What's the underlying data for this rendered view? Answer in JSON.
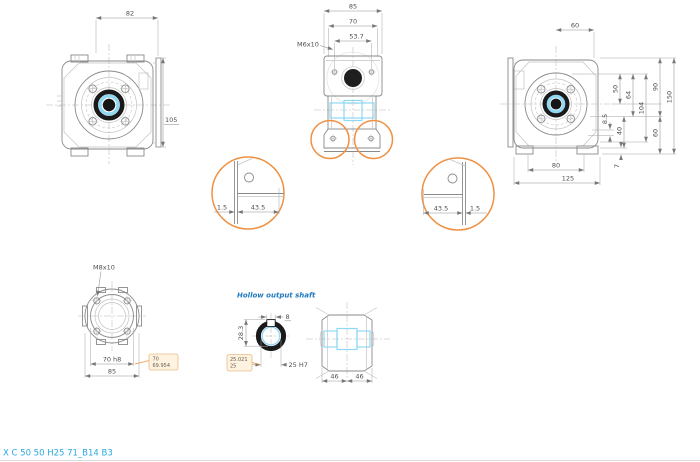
{
  "drawing": {
    "product_code": "X C 50 50 H25 71_B14 B3"
  },
  "colors": {
    "line": "#8a8a8a",
    "dark": "#1a1a1a",
    "dim_text": "#4f4f4f",
    "highlight_cyan": "#8fd8f4",
    "accent_orange": "#ef9143",
    "callout_fill": "#fdf3e0",
    "callout_border": "#e9bc86",
    "note_blue": "#1e79bf",
    "code_blue": "#2aa9e0"
  },
  "front_view": {
    "dim_width": "82",
    "dim_flange_height": "105"
  },
  "top_view": {
    "dim_overall": "85",
    "dim_bolt_circle": "70",
    "dim_bolt_spacing": "53.7",
    "thread_label": "M6x10"
  },
  "back_view": {
    "dim_top": "60",
    "dim_feet_spacing": "80",
    "dim_overall_width": "125",
    "dim_50": "50",
    "dim_64": "64",
    "dim_104": "104",
    "dim_90": "90",
    "dim_60_side": "60",
    "dim_150": "150",
    "dim_40": "40",
    "dim_8_5": "8.5",
    "dim_7": "7"
  },
  "detail_left": {
    "dim_wall": "1.5",
    "dim_foot": "43.5"
  },
  "detail_right": {
    "dim_foot": "43.5",
    "dim_wall": "1.5"
  },
  "flange_view": {
    "thread_label": "M8x10",
    "dim_spigot": "70 h8",
    "dim_overall": "85",
    "callout": {
      "nominal": "70",
      "tolerance": "69.954"
    }
  },
  "hollow_shaft": {
    "title": "Hollow output shaft",
    "dim_keyway_width": "8",
    "dim_keyway_depth": "28.3",
    "dim_bore": "25 H7",
    "callout": {
      "max": "25.021",
      "min": "25"
    }
  },
  "shaft_view": {
    "dim_half_left": "46",
    "dim_half_right": "46"
  }
}
